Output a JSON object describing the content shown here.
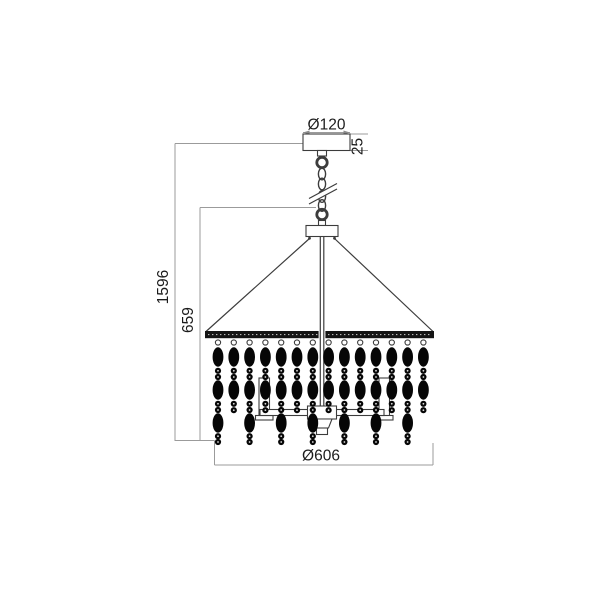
{
  "drawing": {
    "subject": "chandelier pendant lamp technical dimension drawing",
    "dimensions": {
      "canopy_diameter": {
        "label": "Ø120",
        "value_mm": 120
      },
      "canopy_height": {
        "label": "25",
        "value_mm": 25
      },
      "overall_height": {
        "label": "1596",
        "value_mm": 1596
      },
      "body_height": {
        "label": "659",
        "value_mm": 659
      },
      "body_diameter": {
        "label": "Ø606",
        "value_mm": 606
      }
    },
    "colors": {
      "background": "#ffffff",
      "outline": "#3c3c3c",
      "dimension_line": "#9b9b9b",
      "bead_fill": "#060606",
      "label_text": "#1c1c1c"
    },
    "structure": {
      "strand_count": 14,
      "strand_pattern": "alternating long (3 oval beads) and short (2 oval beads) strands"
    }
  }
}
